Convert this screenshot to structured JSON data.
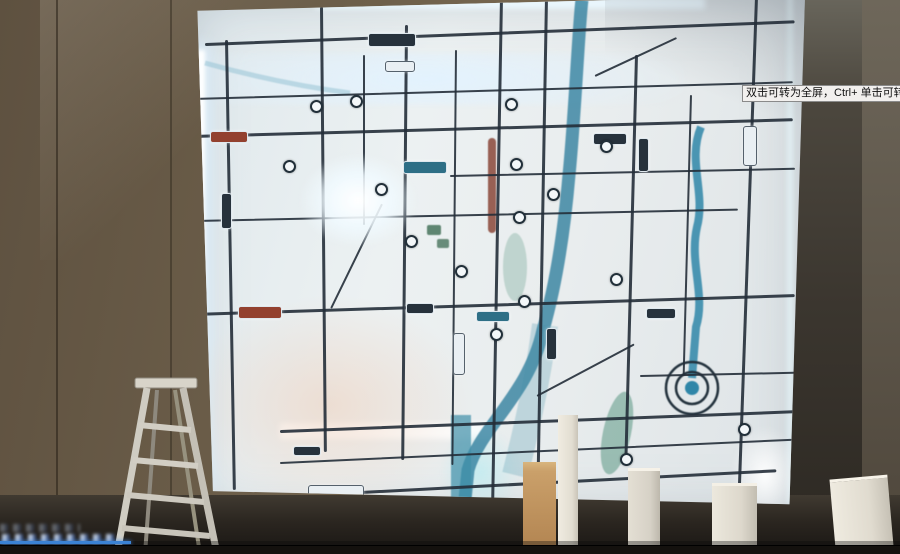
{
  "overlay": {
    "tooltip_text": "双击可转为全屏，Ctrl+ 单击可转为",
    "progress_percent": 14.5
  },
  "colors": {
    "progress": "#3b82d4",
    "road": "#232e38",
    "river": "#2e7d9c",
    "map_backlight": "#ecf1f2",
    "led_glow": "#dff2ff",
    "wall_left": "#6e604b",
    "wall_right": "#3f392f"
  },
  "icons": {
    "station_marker": "ring-dot",
    "spiral_interchange": "concentric-rings"
  }
}
